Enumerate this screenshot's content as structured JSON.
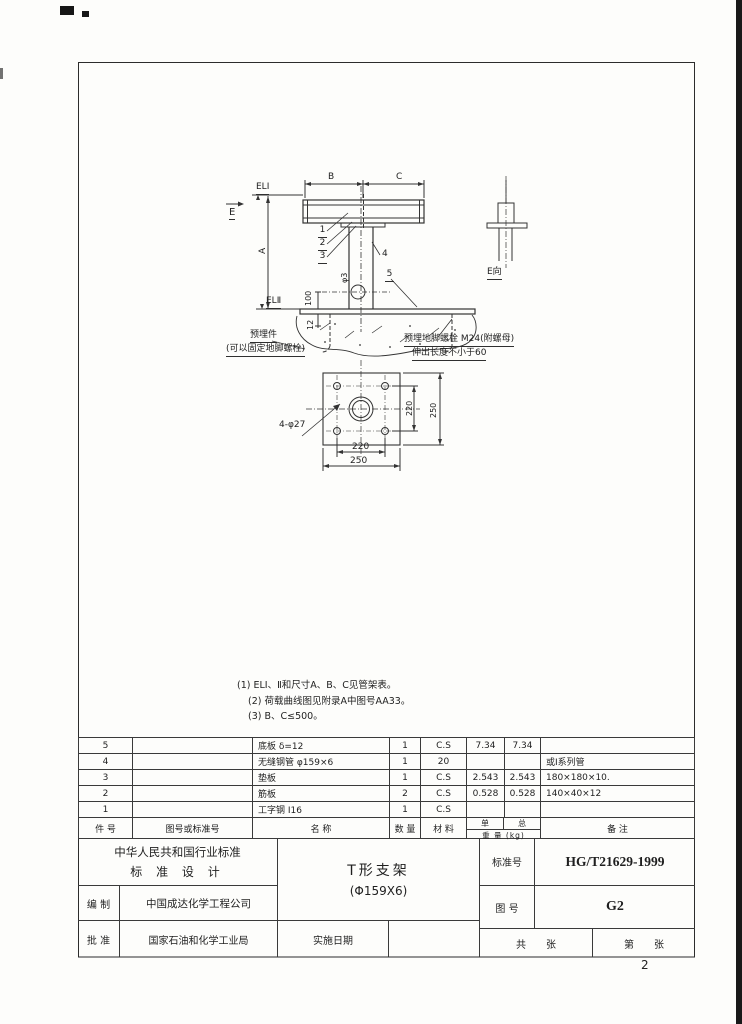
{
  "page": {
    "sheet_number": "2"
  },
  "drawing": {
    "elevation": {
      "dim_b": "B",
      "dim_c": "C",
      "dim_a": "A",
      "el_top": "ELⅠ",
      "el_bottom": "ELⅡ",
      "view_label": "E",
      "callout_1": "1",
      "callout_2": "2",
      "callout_3": "3",
      "callout_4": "4",
      "callout_5": "5",
      "hole_label": "φ3",
      "dim_100": "100",
      "dim_12": "12",
      "embed_note_line1": "预埋件",
      "embed_note_line2": "(可以固定地脚螺栓)",
      "anchor_note_line1": "预埋地脚螺栓 M24(附螺母)",
      "anchor_note_line2": "伸出长度不小于60"
    },
    "bolt_detail": {
      "view_label": "E向"
    },
    "plan": {
      "holes_label": "4-φ27",
      "dim_bolt_spacing_h": "220",
      "dim_plate_width": "250",
      "dim_bolt_spacing_v": "220",
      "dim_plate_height": "250"
    }
  },
  "notes": {
    "note1": "(1) ELⅠ、Ⅱ和尺寸A、B、C见管架表。",
    "note2": "(2) 荷载曲线图见附录A中图号AA33。",
    "note3": "(3) B、C≤500。"
  },
  "parts_table": {
    "col_item": "件  号",
    "col_drawing_no": "图号或标准号",
    "col_name": "名        称",
    "col_qty": "数 量",
    "col_material": "材  料",
    "col_weight_unit": "单",
    "col_weight_total": "总",
    "col_weight_label": "重 量 (kg)",
    "col_remarks": "备        注",
    "rows": [
      {
        "item": "5",
        "std": "",
        "name": "底板 δ=12",
        "qty": "1",
        "mat": "C.S",
        "unit": "7.34",
        "total": "7.34",
        "remark": ""
      },
      {
        "item": "4",
        "std": "",
        "name": "无缝钢管 φ159×6",
        "qty": "1",
        "mat": "20",
        "unit": "",
        "total": "",
        "remark": "或Ⅰ系列管"
      },
      {
        "item": "3",
        "std": "",
        "name": "垫板",
        "qty": "1",
        "mat": "C.S",
        "unit": "2.543",
        "total": "2.543",
        "remark": "180×180×10."
      },
      {
        "item": "2",
        "std": "",
        "name": "筋板",
        "qty": "2",
        "mat": "C.S",
        "unit": "0.528",
        "total": "0.528",
        "remark": "140×40×12"
      },
      {
        "item": "1",
        "std": "",
        "name": "工字钢 I16",
        "qty": "1",
        "mat": "C.S",
        "unit": "",
        "total": "",
        "remark": ""
      }
    ]
  },
  "title_block": {
    "org_line1": "中华人民共和国行业标准",
    "org_line2": "标 准 设 计",
    "prepared_label": "编 制",
    "prepared_by": "中国成达化学工程公司",
    "approved_label": "批 准",
    "approved_by": "国家石油和化学工业局",
    "drawing_title_line1": "T形支架",
    "drawing_title_line2": "(Φ159X6)",
    "implement_date_label": "实施日期",
    "standard_no_label": "标准号",
    "standard_no": "HG/T21629-1999",
    "figure_no_label": "图 号",
    "figure_no": "G2",
    "total_sheets": "共　　张",
    "sheet_no": "第　　张"
  }
}
